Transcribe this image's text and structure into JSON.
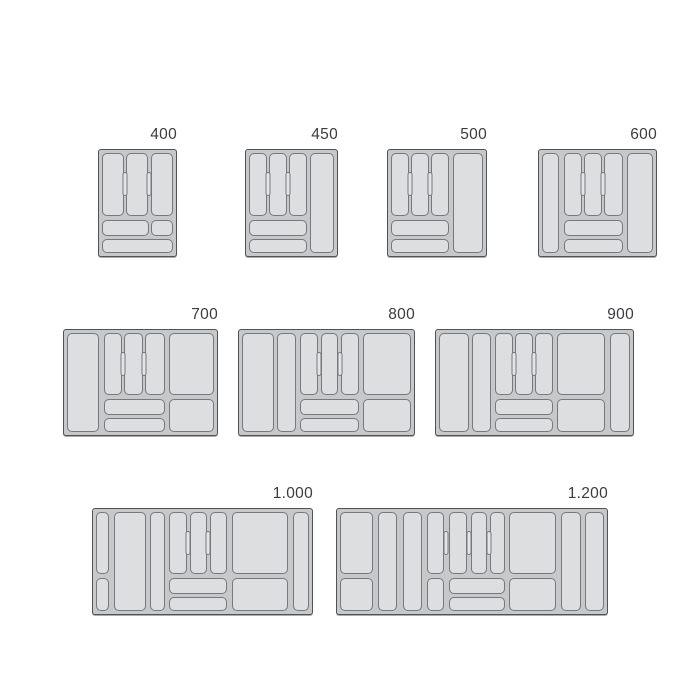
{
  "page": {
    "background": "#ffffff",
    "width": 700,
    "height": 700
  },
  "palette": {
    "tray_field": "#c6c8ca",
    "tray_border": "#505254",
    "compartment_fill": "#dcdee0",
    "compartment_border": "#76787b",
    "pill_fill": "#e3e5e7",
    "label_color": "#3a3c3e"
  },
  "trays": [
    {
      "label": "400",
      "x": 98,
      "y": 149,
      "w": 79,
      "h": 108,
      "cells": [
        [
          0,
          0,
          31,
          63
        ],
        [
          34,
          0,
          31,
          63
        ],
        [
          68.5,
          0,
          31.5,
          63
        ],
        [
          0,
          67,
          65.5,
          15.5
        ],
        [
          68.5,
          67,
          31.5,
          15.5
        ],
        [
          0,
          85.5,
          100,
          14.5
        ]
      ],
      "pills": [
        32.5,
        66.8
      ]
    },
    {
      "label": "450",
      "x": 245,
      "y": 149,
      "w": 93,
      "h": 108,
      "cells": [
        [
          0,
          0,
          21,
          63
        ],
        [
          23.5,
          0,
          21,
          63
        ],
        [
          47,
          0,
          21,
          63
        ],
        [
          0,
          67,
          68,
          15.5
        ],
        [
          0,
          85.5,
          68,
          14.5
        ],
        [
          71.5,
          0,
          28.5,
          100
        ]
      ],
      "pills": [
        22.3,
        45.8
      ]
    },
    {
      "label": "500",
      "x": 387,
      "y": 149,
      "w": 100,
      "h": 108,
      "cells": [
        [
          0,
          0,
          19.5,
          63
        ],
        [
          22,
          0,
          19.5,
          63
        ],
        [
          44,
          0,
          19.5,
          63
        ],
        [
          0,
          67,
          63.5,
          15.5
        ],
        [
          0,
          85.5,
          63.5,
          14.5
        ],
        [
          67.5,
          0,
          32.5,
          100
        ]
      ],
      "pills": [
        20.8,
        42.8
      ]
    },
    {
      "label": "600",
      "x": 538,
      "y": 149,
      "w": 119,
      "h": 108,
      "cells": [
        [
          0,
          0,
          15.5,
          100
        ],
        [
          19.5,
          0,
          16.2,
          63
        ],
        [
          37.9,
          0,
          16.2,
          63
        ],
        [
          56.3,
          0,
          16.7,
          63
        ],
        [
          19.5,
          67,
          53.5,
          15.5
        ],
        [
          19.5,
          85.5,
          53.5,
          14.5
        ],
        [
          76.5,
          0,
          23.5,
          100
        ]
      ],
      "pills": [
        37.05,
        55.4
      ]
    },
    {
      "label": "700",
      "x": 63,
      "y": 329,
      "w": 155,
      "h": 107,
      "cells": [
        [
          0,
          0,
          22,
          100
        ],
        [
          25,
          0,
          12.5,
          63
        ],
        [
          39,
          0,
          12.5,
          63
        ],
        [
          53,
          0,
          13.5,
          63
        ],
        [
          25,
          67,
          41.5,
          15.5
        ],
        [
          25,
          85.5,
          41.5,
          14.5
        ],
        [
          69.5,
          0,
          30.5,
          63
        ],
        [
          69.5,
          67,
          30.5,
          33
        ]
      ],
      "pills": [
        38.25,
        52.25
      ]
    },
    {
      "label": "800",
      "x": 238,
      "y": 329,
      "w": 177,
      "h": 107,
      "cells": [
        [
          0,
          0,
          19,
          100
        ],
        [
          21,
          0,
          11,
          100
        ],
        [
          34.5,
          0,
          10.5,
          63
        ],
        [
          46.5,
          0,
          10.5,
          63
        ],
        [
          58.5,
          0,
          10.5,
          63
        ],
        [
          34.5,
          67,
          34.5,
          15.5
        ],
        [
          34.5,
          85.5,
          34.5,
          14.5
        ],
        [
          71.5,
          0,
          28.5,
          63
        ],
        [
          71.5,
          67,
          28.5,
          33
        ]
      ],
      "pills": [
        45.75,
        57.75
      ]
    },
    {
      "label": "900",
      "x": 435,
      "y": 329,
      "w": 199,
      "h": 107,
      "cells": [
        [
          0,
          0,
          15.5,
          100
        ],
        [
          17.3,
          0,
          10,
          100
        ],
        [
          29.5,
          0,
          9,
          63
        ],
        [
          40,
          0,
          9,
          63
        ],
        [
          50.5,
          0,
          9,
          63
        ],
        [
          29.5,
          67,
          30,
          15.5
        ],
        [
          29.5,
          85.5,
          30,
          14.5
        ],
        [
          62,
          0,
          25,
          63
        ],
        [
          62,
          67,
          25,
          33
        ],
        [
          89.5,
          0,
          10.5,
          100
        ]
      ],
      "pills": [
        39.25,
        49.75
      ]
    },
    {
      "label": "1.000",
      "x": 92,
      "y": 508,
      "w": 221,
      "h": 107,
      "cells": [
        [
          0,
          0,
          6.3,
          63
        ],
        [
          0,
          67,
          6.3,
          33
        ],
        [
          8.3,
          0,
          15,
          100
        ],
        [
          25.3,
          0,
          7.2,
          100
        ],
        [
          34.5,
          0,
          8,
          63
        ],
        [
          44,
          0,
          8,
          63
        ],
        [
          53.5,
          0,
          8,
          63
        ],
        [
          34.5,
          67,
          27,
          15.5
        ],
        [
          34.5,
          85.5,
          27,
          14.5
        ],
        [
          64,
          0,
          26,
          63
        ],
        [
          64,
          67,
          26,
          33
        ],
        [
          92.5,
          0,
          7.5,
          100
        ]
      ],
      "pills": [
        43.25,
        52.75
      ]
    },
    {
      "label": "1.200",
      "x": 336,
      "y": 508,
      "w": 272,
      "h": 107,
      "cells": [
        [
          0,
          0,
          12.6,
          63
        ],
        [
          0,
          67,
          12.6,
          33
        ],
        [
          14.4,
          0,
          7.2,
          100
        ],
        [
          23.8,
          0,
          7.2,
          100
        ],
        [
          33,
          0,
          6.3,
          63
        ],
        [
          33,
          67,
          6.3,
          33
        ],
        [
          41.2,
          0,
          7,
          63
        ],
        [
          49.7,
          0,
          5.8,
          63
        ],
        [
          57,
          0,
          5.5,
          63
        ],
        [
          41.2,
          67,
          21.3,
          15.5
        ],
        [
          41.2,
          85.5,
          21.3,
          14.5
        ],
        [
          64.2,
          0,
          17.8,
          63
        ],
        [
          64.2,
          67,
          17.8,
          33
        ],
        [
          83.7,
          0,
          7.5,
          100
        ],
        [
          92.7,
          0,
          7.3,
          100
        ]
      ],
      "pills": [
        40.25,
        48.95,
        56.25
      ]
    }
  ]
}
